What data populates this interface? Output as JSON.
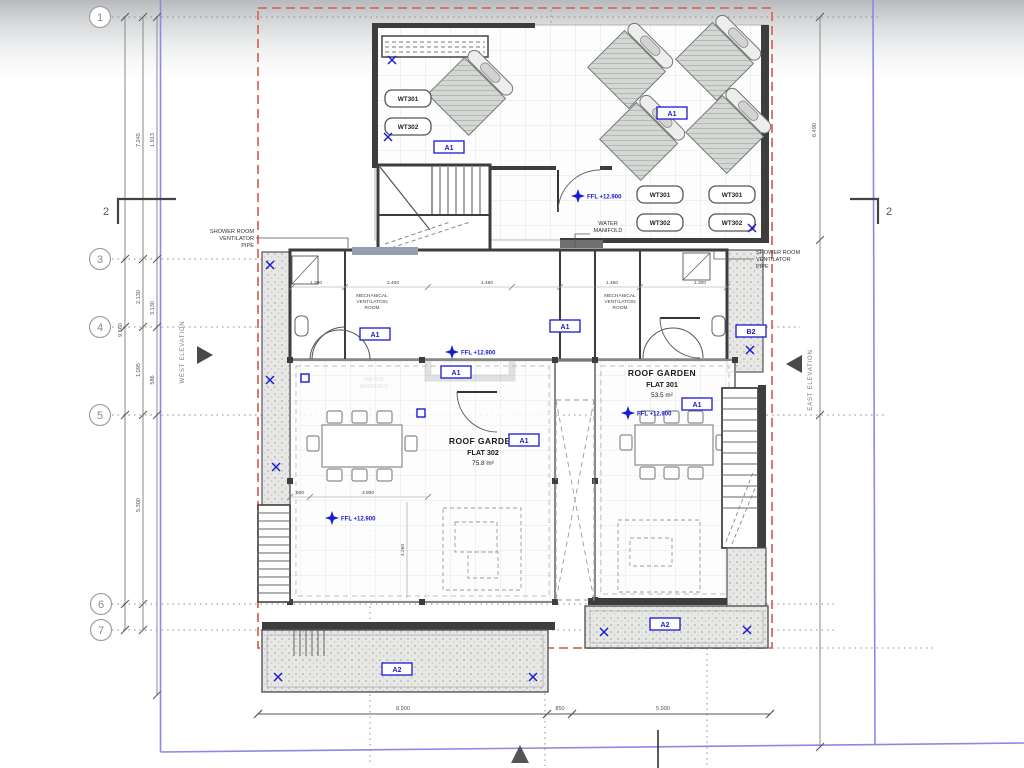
{
  "sheet": {
    "grid_bubbles": [
      "1",
      "3",
      "4",
      "5",
      "6",
      "7"
    ],
    "section_marker": "2"
  },
  "rooms": {
    "flat302": {
      "title": "ROOF GARDEN",
      "name": "FLAT 302",
      "area": "75.8 m²"
    },
    "flat301": {
      "title": "ROOF GARDEN",
      "name": "FLAT 301",
      "area": "53.5 m²"
    }
  },
  "tags": {
    "a1": "A1",
    "a2": "A2",
    "b2": "B2"
  },
  "tanks": {
    "wt301": "WT301",
    "wt302": "WT302"
  },
  "levels": {
    "ffl": "FFL +12.900"
  },
  "notes": {
    "shower_vent": [
      "SHOWER ROOM",
      "VENTILATOR",
      "PIPE"
    ],
    "water_manifold": [
      "WATER",
      "MANIFOLD"
    ],
    "mech_vent": [
      "MECHANICAL",
      "VENTILATION",
      "ROOM"
    ],
    "west_elevation": "WEST ELEVATION",
    "east_elevation": "EAST ELEVATION"
  },
  "dims": {
    "left": [
      "7.245",
      "1.913",
      "9.660",
      "2.130",
      "3.130",
      "1.095",
      "586",
      "5.300"
    ],
    "right_top": "6.490",
    "bottom": [
      "8.900",
      "850",
      "5.990"
    ],
    "rooms_row": [
      "1.300",
      "2.400",
      "1.450",
      "1.450",
      "1.300"
    ],
    "garden": [
      "600",
      "3.800",
      "4.260"
    ]
  },
  "colors": {
    "annotation_blue": "#1a1ad0",
    "boundary_red": "#d96a5e",
    "sheet_border_blue": "#8a8ae6",
    "wall_dark": "#3d3d3d"
  }
}
